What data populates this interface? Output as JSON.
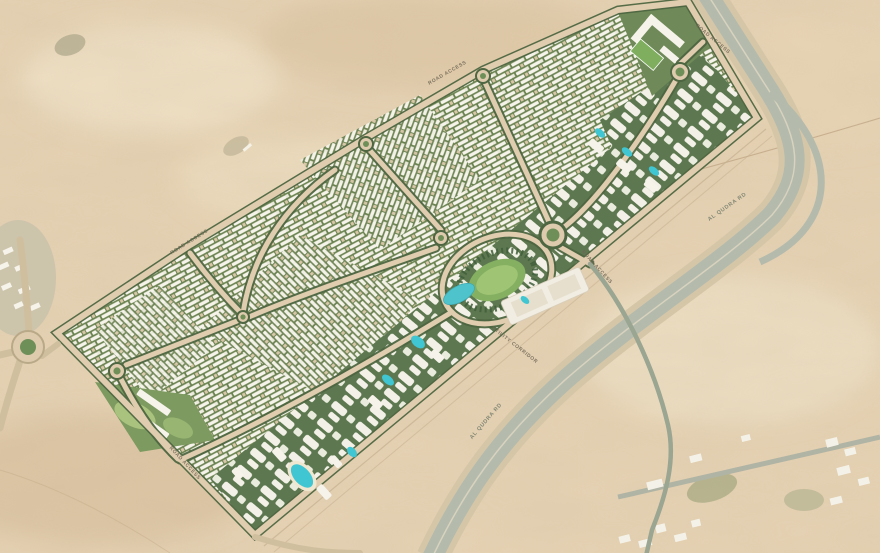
{
  "map": {
    "kind": "aerial-masterplan",
    "description": "Satellite aerial view of desert dunes with a large residential community masterplan overlaid beside a curving highway",
    "labels": {
      "road_access": "ROAD ACCESS",
      "utility_corridor": "UTILITY CORRIDOR",
      "highway_name": "AL QUDRA RD"
    },
    "features": {
      "site": "parallelogram gated community site",
      "villa_fabric": "rows of white-roof villas with green landscaped streets",
      "apartment_band_se": "apartment clusters with pools along south-east edge",
      "apartment_band_ne": "apartment blocks with pools at north-east corner",
      "school_campus": "school campus with sports field at north corner",
      "central_district": "central oval lawn, lake, town centre strip and grand roundabout",
      "lagoon": "teal swimmable lagoon in south-west cluster",
      "entry_roundabout_count": 7,
      "highway": "multi-lane highway curving along the south-east boundary",
      "utility_corridor": "utility corridor strip between site and highway",
      "existing_settlement": "existing low-rise buildings along service road at bottom right",
      "desert": "open sand dunes surrounding the site"
    },
    "colors": {
      "desert_sand": "#e7d3b4",
      "site_road": "#e0ccae",
      "landscape_green": "#5f7a4f",
      "villa_roof_white": "#f8f6ee",
      "water_teal": "#4fc3cb",
      "lawn_green": "#85b061",
      "highway_gray": "#b4bbac",
      "label_text": "#6d6554"
    }
  }
}
